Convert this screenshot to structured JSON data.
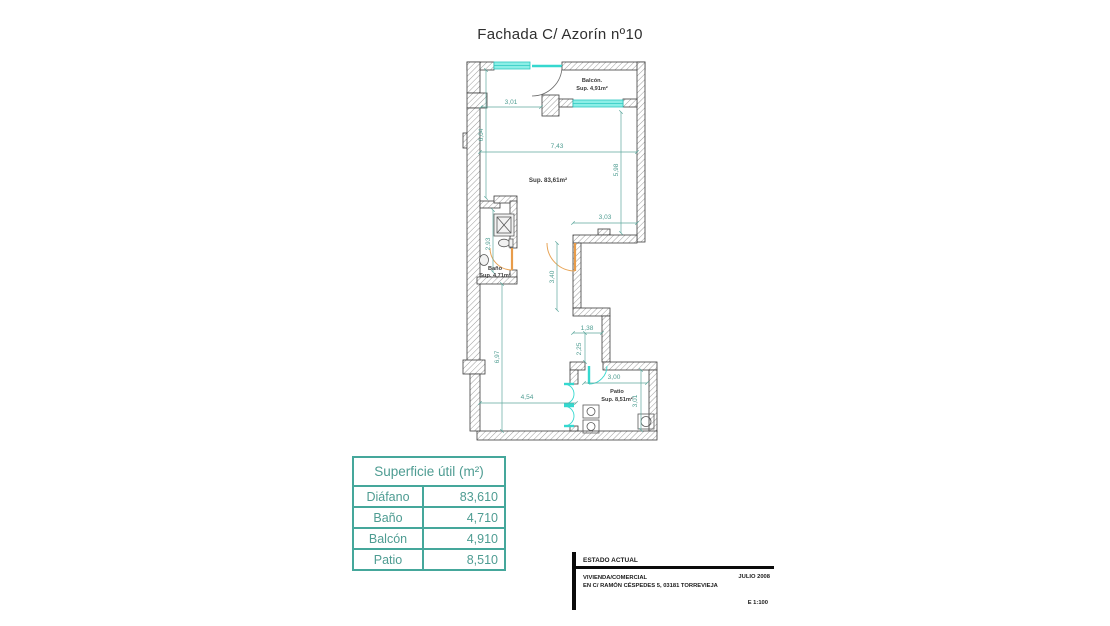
{
  "title": "Fachada C/ Azorín nº10",
  "plan": {
    "rooms": [
      {
        "name": "Balcón.",
        "sup": "Sup. 4,91m²"
      },
      {
        "name": "",
        "sup": "Sup. 83,61m²"
      },
      {
        "name": "Baño",
        "sup": "Sup. 4,71m²"
      },
      {
        "name": "Patio",
        "sup": "Sup. 8,51m²"
      }
    ],
    "dims": [
      {
        "v": "3,01"
      },
      {
        "v": "6,04"
      },
      {
        "v": "7,43"
      },
      {
        "v": "5,98"
      },
      {
        "v": "3,03"
      },
      {
        "v": "3,40"
      },
      {
        "v": "2,93"
      },
      {
        "v": "1,38"
      },
      {
        "v": "2,25"
      },
      {
        "v": "6,97"
      },
      {
        "v": "4,54"
      },
      {
        "v": "3,00"
      },
      {
        "v": "3,01"
      }
    ],
    "colors": {
      "glazing": "#8ceee6",
      "dimension": "#4f9d92",
      "door_swing": "#e89c4a",
      "wall_outline": "#3c3c3c"
    }
  },
  "table": {
    "header": "Superficie útil (m²)",
    "rows": [
      {
        "label": "Diáfano",
        "value": "83,610"
      },
      {
        "label": "Baño",
        "value": "4,710"
      },
      {
        "label": "Balcón",
        "value": "4,910"
      },
      {
        "label": "Patio",
        "value": "8,510"
      }
    ]
  },
  "titleblock": {
    "estado": "ESTADO ACTUAL",
    "line1": "VIVIENDA/COMERCIAL",
    "line2": "EN C/ RAMÓN CÉSPEDES 5, 03181 TORREVIEJA",
    "date": "JULIO 2008",
    "scale": "E 1:100"
  }
}
